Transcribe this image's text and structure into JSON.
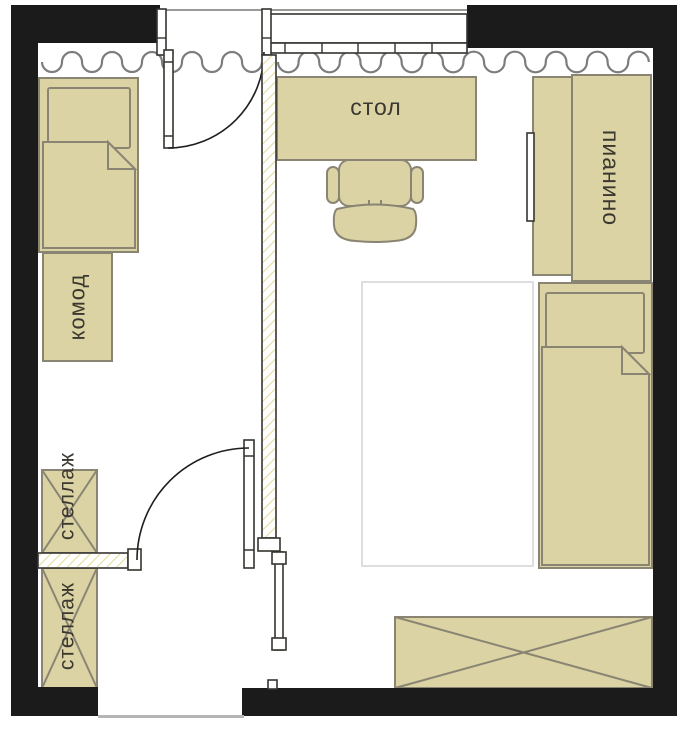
{
  "plan": {
    "labels": {
      "desk": "стол",
      "piano": "пианино",
      "dresser": "комод",
      "shelf_upper": "стеллаж",
      "shelf_lower": "стеллаж"
    },
    "colors": {
      "furniture_fill": "#dbd3a4",
      "furniture_stroke": "#8a8573",
      "wall": "#1b1b1b",
      "line": "#35342f",
      "curtain": "#7d7d7d",
      "hatch": "#e4dd9d",
      "label_text": "#3a382f",
      "rug_border": "#dedede",
      "threshold": "#b5b5b5",
      "exterior_line": "#9a9a9a"
    }
  }
}
